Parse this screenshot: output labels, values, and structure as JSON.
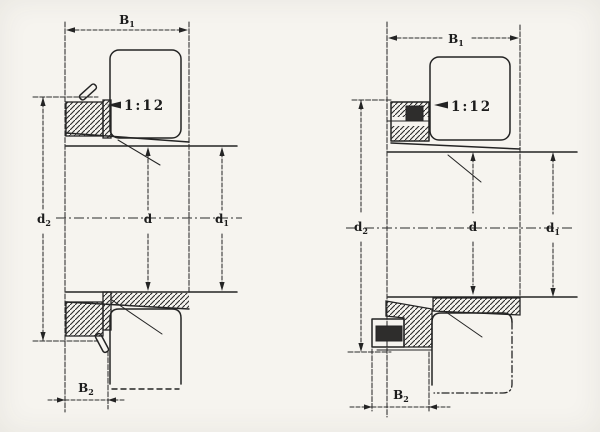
{
  "document": {
    "type": "scanned technical drawing",
    "description": "Cross-section drawings of two bearing adapter sleeve assemblies with locknuts, taper 1:12"
  },
  "colors": {
    "paper": "#f6f4ef",
    "ink": "#242424"
  },
  "figures": {
    "left": {
      "id": "adapter-sleeve-type-1",
      "labels": {
        "b1": {
          "base": "B",
          "sub": "1"
        },
        "taper": "1:12",
        "d2": {
          "base": "d",
          "sub": "2"
        },
        "d": {
          "base": "d",
          "sub": ""
        },
        "d1": {
          "base": "d",
          "sub": "1"
        },
        "b2": {
          "base": "B",
          "sub": "2"
        }
      }
    },
    "right": {
      "id": "adapter-sleeve-type-2",
      "labels": {
        "b1": {
          "base": "B",
          "sub": "1"
        },
        "taper": "1:12",
        "d2": {
          "base": "d",
          "sub": "2"
        },
        "d": {
          "base": "d",
          "sub": ""
        },
        "d1": {
          "base": "d",
          "sub": "1"
        },
        "b2": {
          "base": "B",
          "sub": "2"
        }
      }
    }
  }
}
